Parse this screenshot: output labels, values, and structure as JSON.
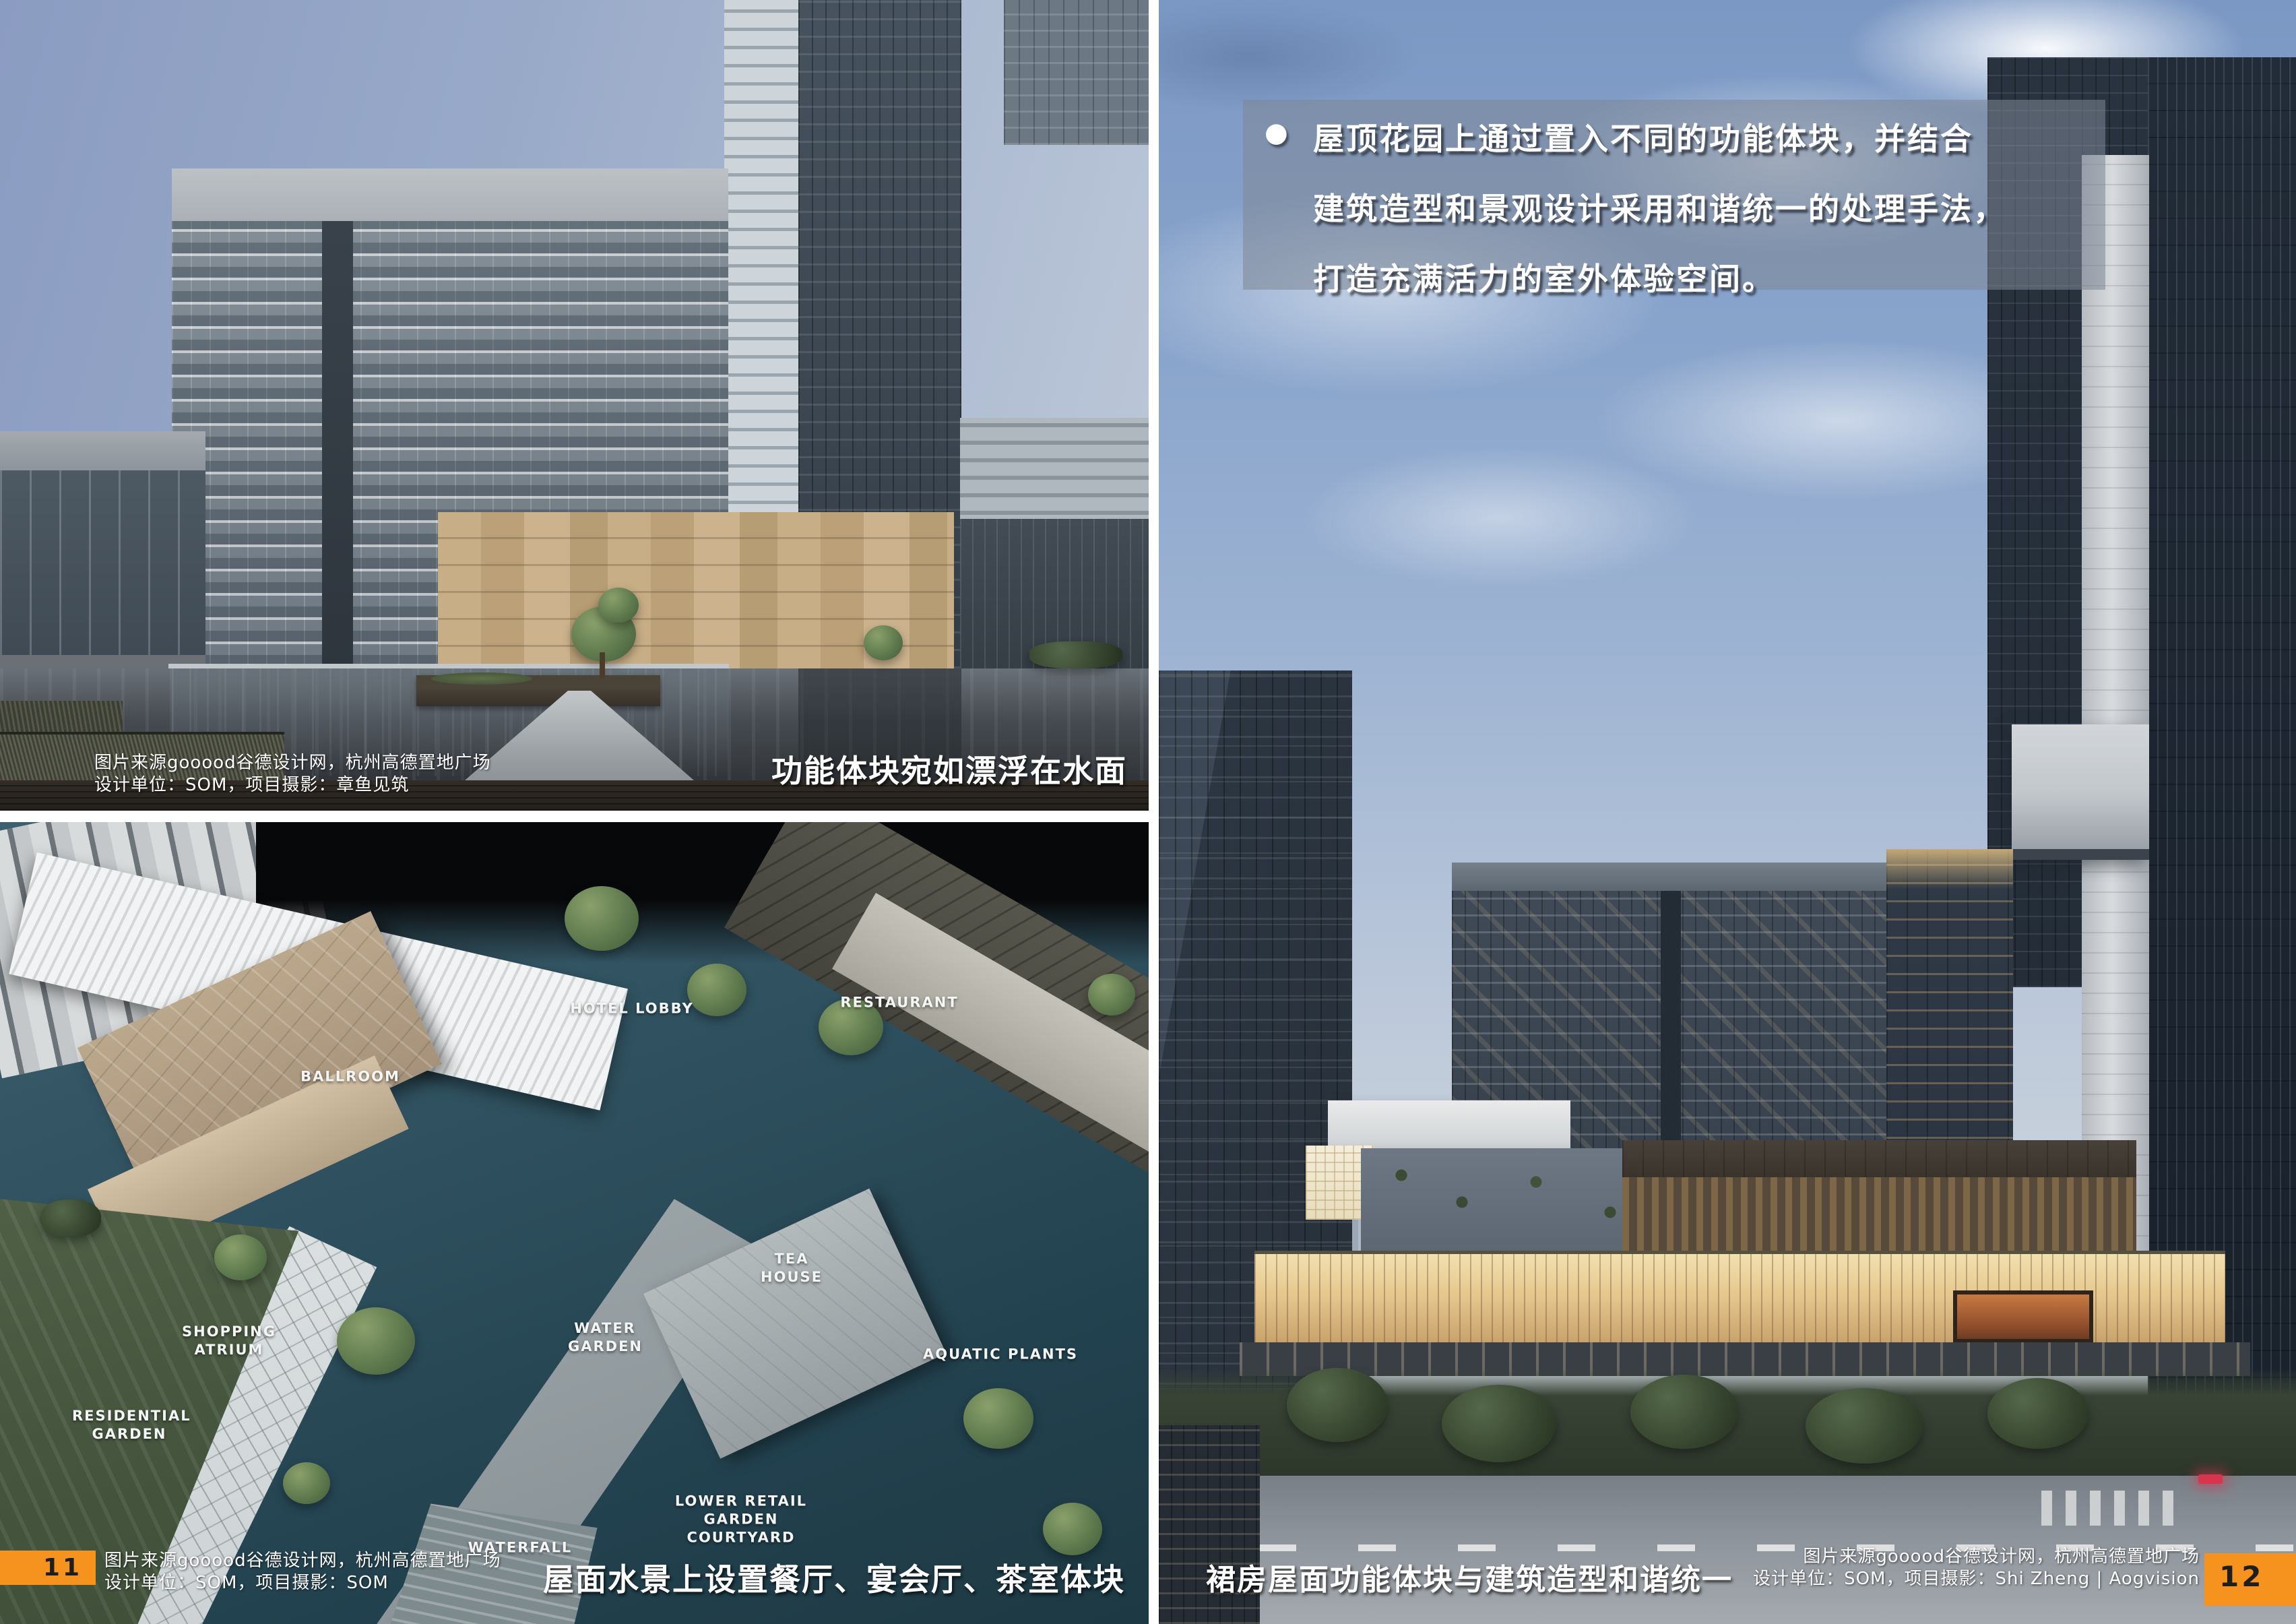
{
  "page": {
    "left_page_number": "11",
    "right_page_number": "12",
    "accent_orange": "#F6921E"
  },
  "top_left_photo": {
    "credit": {
      "line1": "图片来源gooood谷德设计网，杭州高德置地广场",
      "line2": "设计单位：SOM，项目摄影：章鱼见筑"
    },
    "caption": "功能体块宛如漂浮在水面"
  },
  "bottom_left_photo": {
    "labels": {
      "hotel_lobby": "HOTEL LOBBY",
      "restaurant": "RESTAURANT",
      "ballroom": "BALLROOM",
      "tea_house": "TEA HOUSE",
      "water_garden": "WATER GARDEN",
      "aquatic_plants": "AQUATIC PLANTS",
      "shopping_atrium": "SHOPPING ATRIUM",
      "residential_garden": "RESIDENTIAL GARDEN",
      "lower_retail": "LOWER RETAIL GARDEN COURTYARD",
      "waterfall": "WATERFALL"
    },
    "credit": {
      "line1": "图片来源gooood谷德设计网，杭州高德置地广场",
      "line2": "设计单位：SOM，项目摄影：SOM"
    },
    "caption": "屋面水景上设置餐厅、宴会厅、茶室体块"
  },
  "right_photo": {
    "overlay": {
      "bullet": "●",
      "line1": "屋顶花园上通过置入不同的功能体块，并结合",
      "line2": "建筑造型和景观设计采用和谐统一的处理手法，",
      "line3": "打造充满活力的室外体验空间。"
    },
    "caption": "裙房屋面功能体块与建筑造型和谐统一",
    "credit": {
      "line1": "图片来源gooood谷德设计网，杭州高德置地广场",
      "line2": "设计单位：SOM，项目摄影：Shi Zheng | Aogvision"
    }
  }
}
